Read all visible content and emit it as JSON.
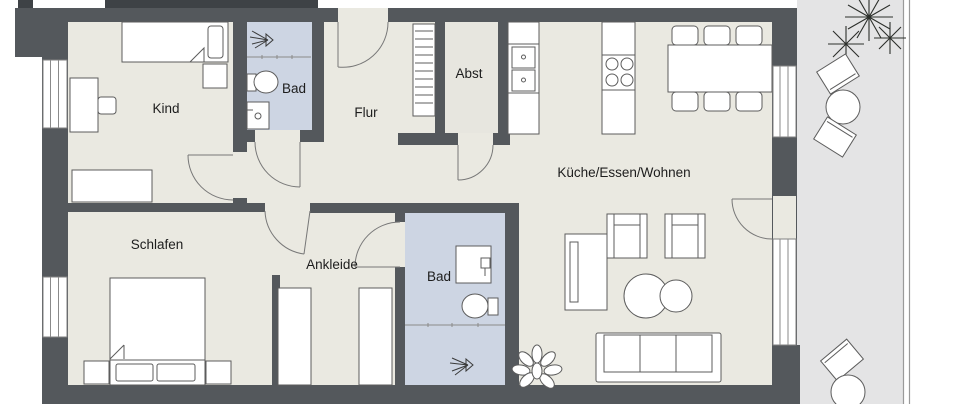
{
  "plan": {
    "type": "floor-plan",
    "rooms": {
      "kind": {
        "label": "Kind"
      },
      "bad_top": {
        "label": "Bad"
      },
      "flur": {
        "label": "Flur"
      },
      "abst": {
        "label": "Abst"
      },
      "wohnen": {
        "label": "Küche/Essen/Wohnen"
      },
      "schlafen": {
        "label": "Schlafen"
      },
      "ankleide": {
        "label": "Ankleide"
      },
      "bad_bottom": {
        "label": "Bad"
      }
    },
    "colors": {
      "wall": "#54585c",
      "wall_dark": "#3e4246",
      "room_floor": "#eae9e1",
      "bath_floor": "#cdd5e3",
      "terrace_floor": "#e4e4e5",
      "background": "#ffffff"
    }
  }
}
